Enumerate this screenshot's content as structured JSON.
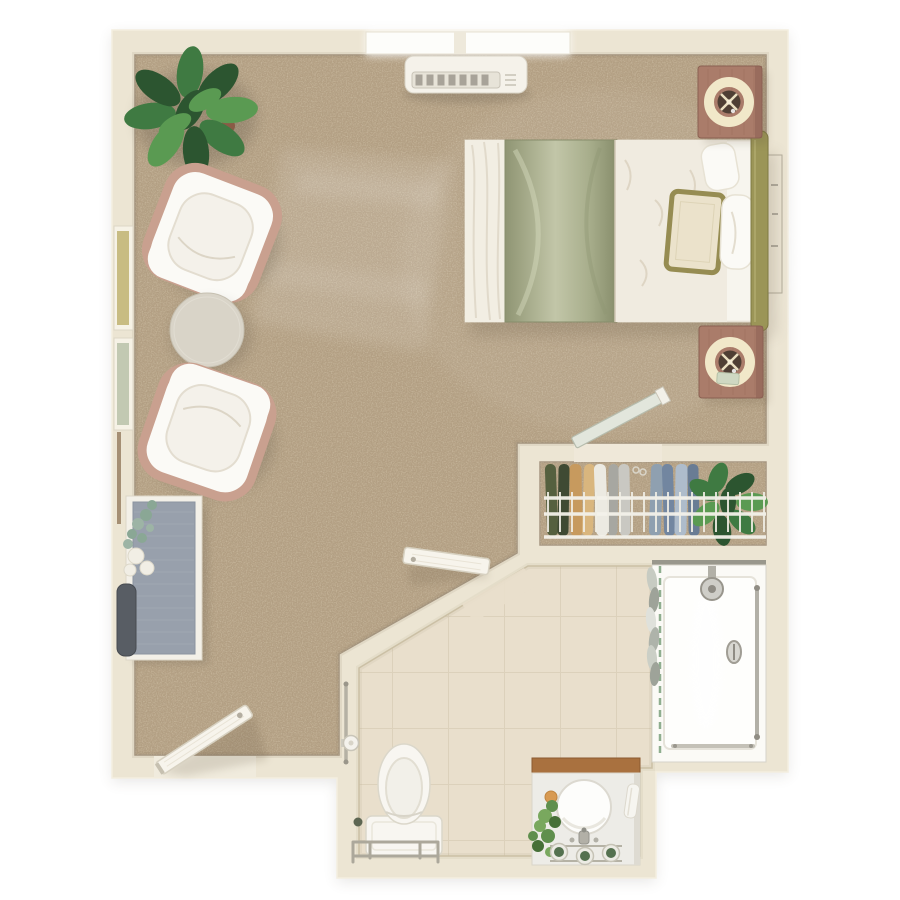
{
  "plan": {
    "kind": "studio-apartment-floor-plan",
    "view": "top-down-3d-render"
  },
  "rooms": {
    "bedroom": {
      "name": "bedroom / living area",
      "floor": "carpet",
      "items": [
        "window",
        "air-conditioner",
        "bed",
        "headboard",
        "pillows",
        "nightstand-with-lamp-top",
        "nightstand-with-lamp-bottom",
        "wall-art",
        "corner-plant",
        "armchair-top",
        "armchair-bottom",
        "coffee-table",
        "desk",
        "desk-chair",
        "desk-plant",
        "left-window-upper",
        "left-window-lower",
        "entry-door"
      ]
    },
    "closet": {
      "name": "walk-in closet",
      "floor": "carpet",
      "items": [
        "wire-shelf",
        "hanging-clothes",
        "closet-plant",
        "closet-door"
      ],
      "clothes_colors": [
        "#55603f",
        "#3f4a33",
        "#c79a5e",
        "#d9b67e",
        "#eceae2",
        "#a7a7a1",
        "#c9c8c2",
        "#8fa0b0",
        "#7286a0",
        "#aebccb",
        "#697c94"
      ]
    },
    "bathroom": {
      "name": "bathroom",
      "floor": "tile",
      "items": [
        "toilet",
        "toilet-grab-rail",
        "wall-grab-bar",
        "toilet-paper-holder",
        "vanity",
        "round-sink",
        "faucet",
        "vanity-plant",
        "soap",
        "jars",
        "towel",
        "shower",
        "shower-head",
        "shower-control",
        "shower-curtain",
        "shower-grab-bar",
        "drain",
        "bathroom-door"
      ]
    }
  },
  "colors": {
    "wall": "#ece5d3",
    "wall_light": "#f6f1e4",
    "wall_edge": "#d8d0bb",
    "carpet": "#b4a084",
    "tile": "#e9dfcc",
    "tile_line": "#d8ccb4",
    "sheet": "#f3efe6",
    "runner": "#a8ae8c",
    "runner_hi": "#cdd1b4",
    "duvet": "#f0ebe0",
    "mattress": "#f7f5ee",
    "headboard": "#9b9557",
    "headboard_edge": "#7f7a43",
    "pillow": "#fbfaf6",
    "pillow_accent": "#ebe2cb",
    "pillow_trim": "#968c52",
    "nightstand": "#aa7c6a",
    "lamp_ring": "#f1e8c9",
    "lamp_center": "#4f3f34",
    "chair_trim": "#c9a08f",
    "chair_seat": "#fbfaf6",
    "chair_inner": "#f4f1ea",
    "table": "#d9d4c8",
    "table_edge": "#c6c0b1",
    "desk_top": "#98a0ac",
    "desk_frame": "#f3f0e8",
    "desk_chair": "#585d64",
    "plant_dark": "#2c5530",
    "plant_mid": "#3f7a42",
    "plant_light": "#5a9a52",
    "eucalyptus": "#8aa795",
    "blossom": "#f1eee5",
    "ac_body": "#f5f2ea",
    "ac_slat": "#a8a399",
    "window": "#fdfdfa",
    "art_frame": "#ece5d4",
    "door": "#f7f4ec",
    "door_edge": "#d7d1c1",
    "closet_door": "#e2e6dc",
    "closet_door_edge": "#b6bcad",
    "rail": "#f3f1ea",
    "shower_pan": "#fbfaf6",
    "shower_edge": "#85837a",
    "rod": "#8fae8f",
    "curtain": "#b9bdb4",
    "metal": "#b2b0a7",
    "porcelain": "#f8f6f1",
    "porcelain_edge": "#dbd7ca",
    "vanity": "#edece7",
    "vanity_wood": "#a9713f",
    "jar": "#54714f",
    "soap": "#d89a52"
  }
}
